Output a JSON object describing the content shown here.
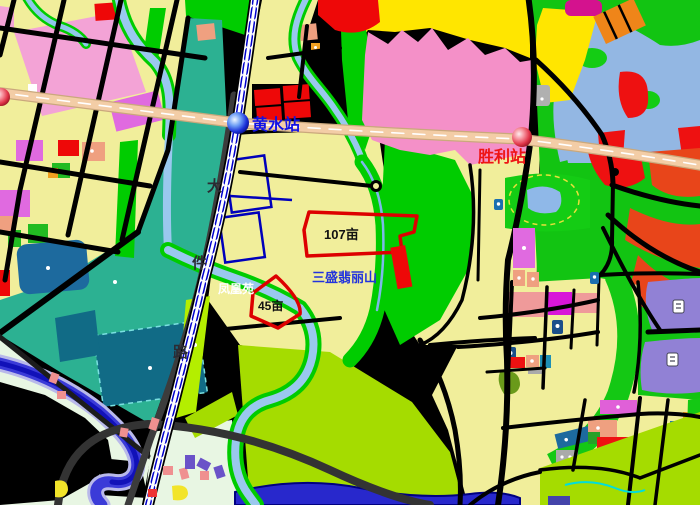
{
  "map": {
    "stations": [
      {
        "name": "黄水站",
        "text_color": "#1212e6",
        "marker": "blue-sphere"
      },
      {
        "name": "胜利站",
        "text_color": "#ee1414",
        "marker": "red-sphere"
      }
    ],
    "highlighted_parcels": [
      {
        "label": "107亩",
        "outline_color": "#dd0000"
      },
      {
        "label": "45亩",
        "outline_color": "#dd0000"
      }
    ],
    "place_labels": [
      {
        "text": "三盛翡丽山",
        "color": "#2233dd"
      },
      {
        "text": "凤凰苑",
        "color": "#ffffff"
      }
    ],
    "road_label": {
      "name": "大件路",
      "chars": [
        "大",
        "件",
        "路"
      ]
    },
    "palette": {
      "parcel_yellow": "#f1ee9b",
      "bright_yellow": "#ffe600",
      "teal": "#2cb192",
      "dark_teal_parcel": "#116b86",
      "green": "#00cc00",
      "chartreuse": "#a5dc00",
      "pale_green": "#e8f6e3",
      "pink_blob": "#f490c8",
      "violet": "#e06ae0",
      "red_parcel": "#ee0808",
      "orange_red": "#e8451a",
      "salmon": "#efa080",
      "purple": "#9181d5",
      "steel_blue": "#1d6a9e",
      "light_blue_zone": "#93b7e3",
      "river_blue": "#9ac8ee",
      "deep_river": "#3b3bd8",
      "highway": "#f3cda6",
      "road_black": "#000000",
      "highlight_red": "#dd0000",
      "station_blue": "#1b2fd8",
      "station_red": "#e03448"
    }
  }
}
